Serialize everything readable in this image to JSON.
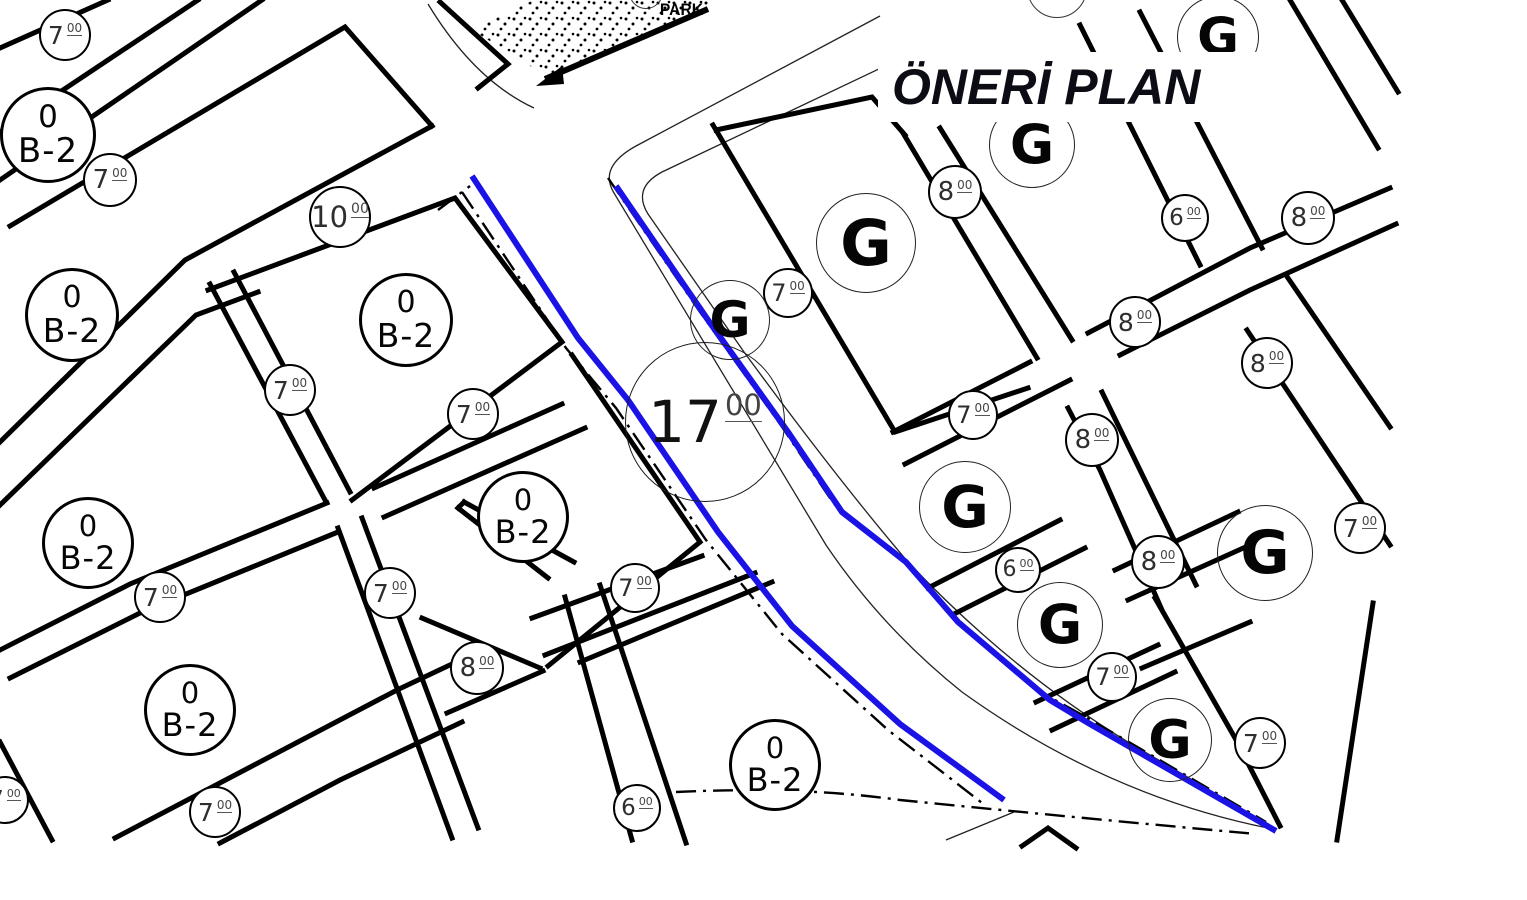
{
  "title": "ÖNERİ PLAN",
  "park_label": "PARK",
  "colors": {
    "ink": "#000000",
    "thin_line": "#222222",
    "highlight_blue": "#1b12e6",
    "circle_text": "#2e2e2e",
    "title_text": "#0c0c14"
  },
  "map_labels": [
    {
      "kind": "w",
      "x": 65,
      "y": 35,
      "r": 26,
      "value": "7",
      "sup": "00"
    },
    {
      "kind": "w",
      "x": 110,
      "y": 180,
      "r": 27,
      "value": "7",
      "sup": "00"
    },
    {
      "kind": "w",
      "x": 340,
      "y": 217,
      "r": 31,
      "value": "10",
      "sup": "00"
    },
    {
      "kind": "w",
      "x": 290,
      "y": 390,
      "r": 26,
      "value": "7",
      "sup": "00"
    },
    {
      "kind": "w",
      "x": 473,
      "y": 414,
      "r": 26,
      "value": "7",
      "sup": "00"
    },
    {
      "kind": "w",
      "x": 160,
      "y": 597,
      "r": 26,
      "value": "7",
      "sup": "00"
    },
    {
      "kind": "w",
      "x": 390,
      "y": 593,
      "r": 26,
      "value": "7",
      "sup": "00"
    },
    {
      "kind": "w",
      "x": 215,
      "y": 812,
      "r": 26,
      "value": "7",
      "sup": "00"
    },
    {
      "kind": "w",
      "x": 5,
      "y": 800,
      "r": 24,
      "value": "7",
      "sup": "00"
    },
    {
      "kind": "w",
      "x": 635,
      "y": 588,
      "r": 25,
      "value": "7",
      "sup": "00"
    },
    {
      "kind": "w",
      "x": 477,
      "y": 668,
      "r": 27,
      "value": "8",
      "sup": "00"
    },
    {
      "kind": "w",
      "x": 637,
      "y": 808,
      "r": 24,
      "value": "6",
      "sup": "00"
    },
    {
      "kind": "w",
      "x": 788,
      "y": 293,
      "r": 25,
      "value": "7",
      "sup": "00"
    },
    {
      "kind": "w",
      "x": 955,
      "y": 192,
      "r": 27,
      "value": "8",
      "sup": "00"
    },
    {
      "kind": "w",
      "x": 1185,
      "y": 218,
      "r": 24,
      "value": "6",
      "sup": "00"
    },
    {
      "kind": "w",
      "x": 1308,
      "y": 218,
      "r": 27,
      "value": "8",
      "sup": "00"
    },
    {
      "kind": "w",
      "x": 1135,
      "y": 322,
      "r": 26,
      "value": "8",
      "sup": "00"
    },
    {
      "kind": "w",
      "x": 1267,
      "y": 363,
      "r": 26,
      "value": "8",
      "sup": "00"
    },
    {
      "kind": "w",
      "x": 973,
      "y": 415,
      "r": 25,
      "value": "7",
      "sup": "00"
    },
    {
      "kind": "w",
      "x": 1092,
      "y": 440,
      "r": 27,
      "value": "8",
      "sup": "00"
    },
    {
      "kind": "w",
      "x": 1018,
      "y": 570,
      "r": 23,
      "value": "6",
      "sup": "00"
    },
    {
      "kind": "w",
      "x": 1158,
      "y": 562,
      "r": 27,
      "value": "8",
      "sup": "00"
    },
    {
      "kind": "w",
      "x": 1112,
      "y": 677,
      "r": 25,
      "value": "7",
      "sup": "00"
    },
    {
      "kind": "w",
      "x": 1360,
      "y": 528,
      "r": 26,
      "value": "7",
      "sup": "00"
    },
    {
      "kind": "w",
      "x": 1260,
      "y": 743,
      "r": 26,
      "value": "7",
      "sup": "00"
    },
    {
      "kind": "W",
      "x": 705,
      "y": 422,
      "r": 80,
      "value": "17",
      "sup": "00"
    },
    {
      "kind": "z",
      "x": 48,
      "y": 135,
      "r": 48,
      "top": "0",
      "text": "B-2"
    },
    {
      "kind": "z",
      "x": 72,
      "y": 315,
      "r": 47,
      "top": "0",
      "text": "B-2"
    },
    {
      "kind": "z",
      "x": 406,
      "y": 320,
      "r": 47,
      "top": "0",
      "text": "B-2"
    },
    {
      "kind": "z",
      "x": 88,
      "y": 543,
      "r": 46,
      "top": "0",
      "text": "B-2"
    },
    {
      "kind": "z",
      "x": 523,
      "y": 517,
      "r": 46,
      "top": "0",
      "text": "B-2"
    },
    {
      "kind": "z",
      "x": 190,
      "y": 710,
      "r": 46,
      "top": "0",
      "text": "B-2"
    },
    {
      "kind": "z",
      "x": 775,
      "y": 765,
      "r": 46,
      "top": "0",
      "text": "B-2"
    },
    {
      "kind": "g",
      "x": 1218,
      "y": 37,
      "r": 41,
      "text": "G"
    },
    {
      "kind": "g",
      "x": 1032,
      "y": 145,
      "r": 43,
      "text": "G"
    },
    {
      "kind": "g",
      "x": 866,
      "y": 243,
      "r": 50,
      "text": "G"
    },
    {
      "kind": "g",
      "x": 730,
      "y": 320,
      "r": 40,
      "text": "G"
    },
    {
      "kind": "g",
      "x": 965,
      "y": 507,
      "r": 46,
      "text": "G"
    },
    {
      "kind": "g",
      "x": 1060,
      "y": 625,
      "r": 43,
      "text": "G"
    },
    {
      "kind": "g",
      "x": 1265,
      "y": 553,
      "r": 48,
      "text": "G"
    },
    {
      "kind": "g",
      "x": 1170,
      "y": 740,
      "r": 42,
      "text": "G"
    },
    {
      "kind": "e",
      "x": 646,
      "y": -8,
      "r": 17
    },
    {
      "kind": "e",
      "x": 1057,
      "y": -12,
      "r": 30
    }
  ]
}
